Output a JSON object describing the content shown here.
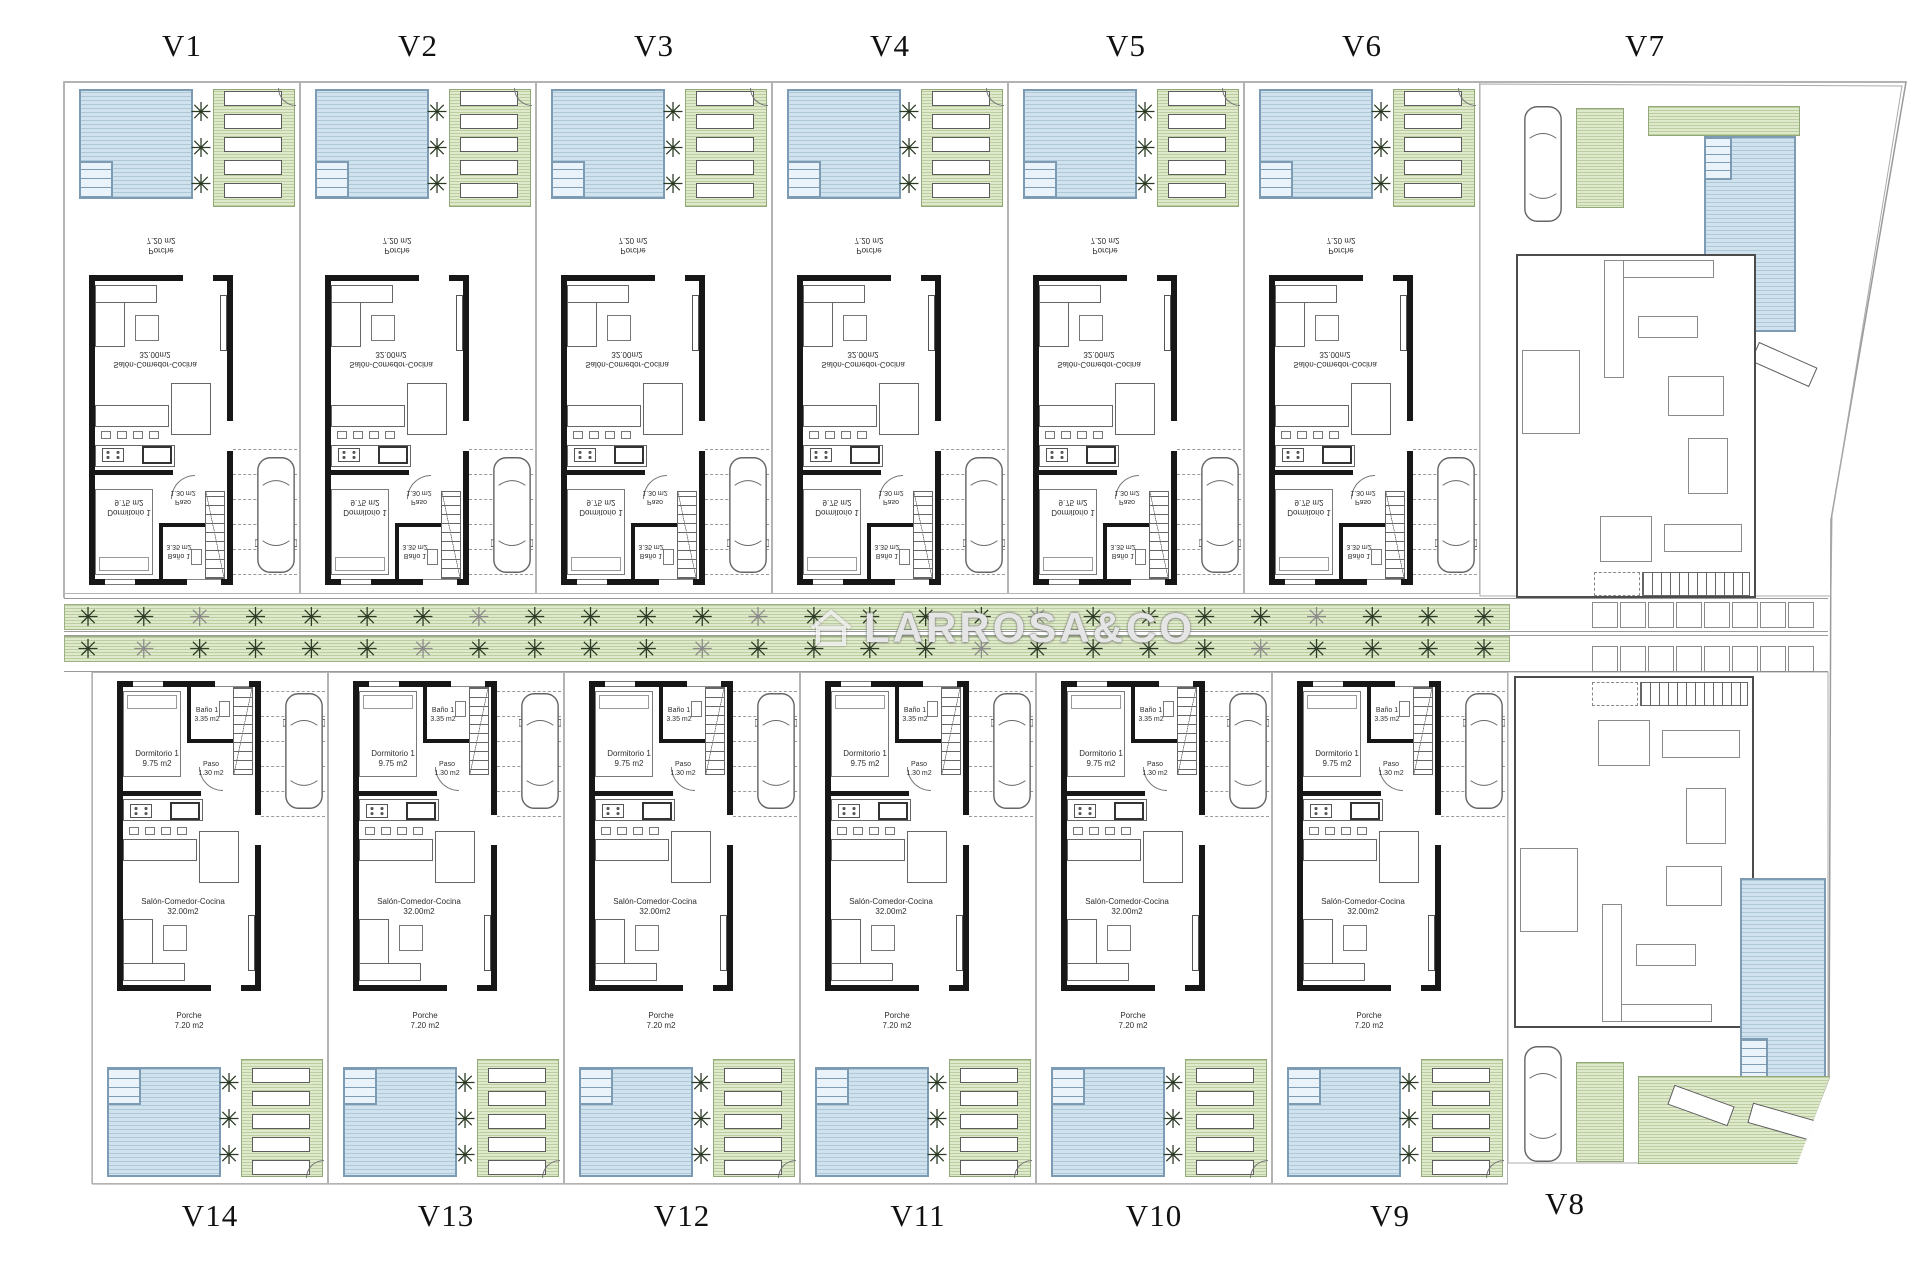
{
  "villa_labels": {
    "top": [
      "V1",
      "V2",
      "V3",
      "V4",
      "V5",
      "V6",
      "V7"
    ],
    "bottom": [
      "V14",
      "V13",
      "V12",
      "V11",
      "V10",
      "V9",
      "V8"
    ]
  },
  "room_labels": {
    "porche": {
      "name": "Porche",
      "area": "7.20 m2"
    },
    "salon": {
      "name": "Salón-Comedor-Cocina",
      "area": "32.00m2"
    },
    "dormitorio": {
      "name": "Dormitorio 1",
      "area": "9.75 m2"
    },
    "bano": {
      "name": "Baño 1",
      "area": "3.35 m2"
    },
    "paso": {
      "name": "Paso",
      "area": "1.30 m2"
    }
  },
  "watermark": {
    "text": "LARROSA&CO",
    "icon": "house-icon"
  },
  "icons": {
    "tree_glyph": "✳"
  },
  "road": {
    "tree_rows": 2,
    "trees_per_row": 26,
    "stalls_per_row": 8
  },
  "colors": {
    "pool_fill": "#cfe2ee",
    "pool_border": "#7d9cb4",
    "green_fill": "#dfe9cb",
    "wall": "#171717",
    "tree": "#2c3b26",
    "label_text": "#2e2e2e"
  }
}
